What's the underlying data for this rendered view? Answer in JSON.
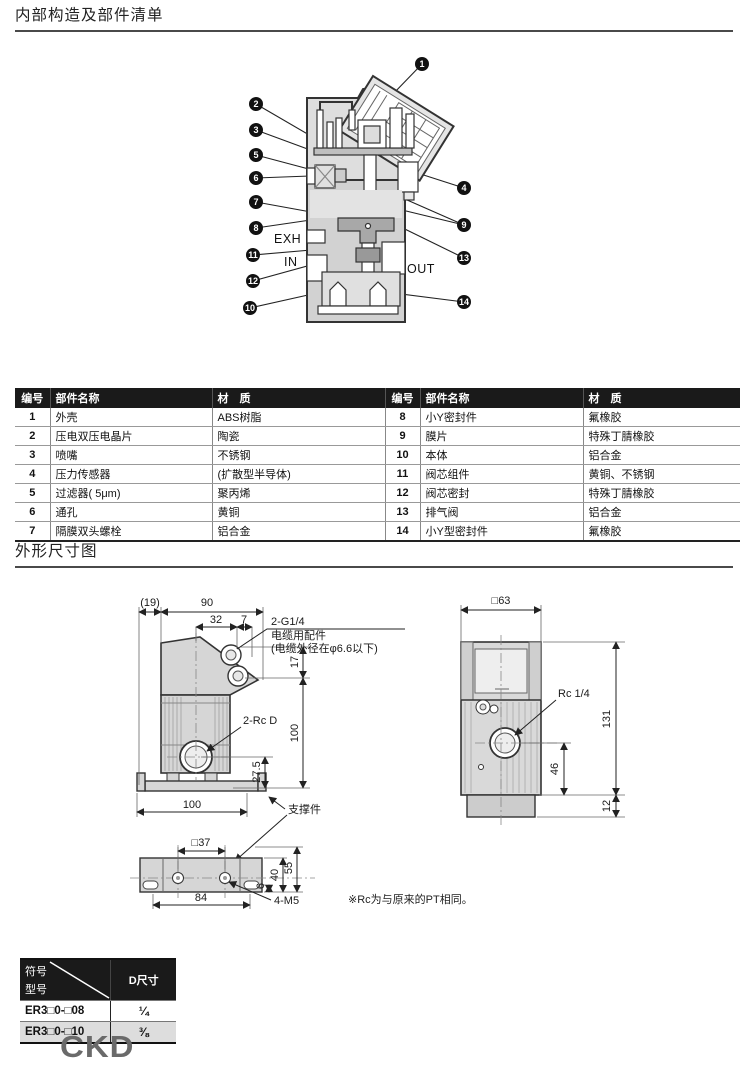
{
  "page": {
    "section1_title": "内部构造及部件清单",
    "section2_title": "外形尺寸图",
    "note": "※Rc为与原来的PT相同。",
    "logo": "CKD"
  },
  "colors": {
    "table_header_bg": "#1a1a1a",
    "alt_row_bg": "#dddddd",
    "drawing_fill": "#d6d6d6",
    "logo_gray": "#6a6a6a"
  },
  "diagram": {
    "callouts": [
      "1",
      "2",
      "3",
      "4",
      "5",
      "6",
      "7",
      "8",
      "9",
      "10",
      "11",
      "12",
      "13",
      "14"
    ],
    "port_labels": {
      "exh": "EXH",
      "in": "IN",
      "out": "OUT"
    }
  },
  "parts_table": {
    "headers": {
      "no": "编号",
      "name": "部件名称",
      "material": "材　质"
    },
    "left_rows": [
      {
        "no": "1",
        "name": "外壳",
        "material": "ABS树脂"
      },
      {
        "no": "2",
        "name": "压电双压电晶片",
        "material": "陶瓷"
      },
      {
        "no": "3",
        "name": "喷嘴",
        "material": "不锈钢"
      },
      {
        "no": "4",
        "name": "压力传感器",
        "material": "(扩散型半导体)"
      },
      {
        "no": "5",
        "name": "过滤器( 5μm)",
        "material": "聚丙烯"
      },
      {
        "no": "6",
        "name": "通孔",
        "material": "黄铜"
      },
      {
        "no": "7",
        "name": "隔膜双头螺栓",
        "material": "铝合金"
      }
    ],
    "right_rows": [
      {
        "no": "8",
        "name": "小Y密封件",
        "material": "氟橡胶"
      },
      {
        "no": "9",
        "name": "膜片",
        "material": "特殊丁腈橡胶"
      },
      {
        "no": "10",
        "name": "本体",
        "material": "铝合金"
      },
      {
        "no": "11",
        "name": "阀芯组件",
        "material": "黄铜、不锈钢"
      },
      {
        "no": "12",
        "name": "阀芯密封",
        "material": "特殊丁腈橡胶"
      },
      {
        "no": "13",
        "name": "排气阀",
        "material": "铝合金"
      },
      {
        "no": "14",
        "name": "小Y型密封件",
        "material": "氟橡胶"
      }
    ]
  },
  "dimensions": {
    "front_view": {
      "d19": "(19)",
      "d90": "90",
      "d32": "32",
      "d7": "7",
      "g14_label": "2-G1/4",
      "cable_label": "电缆用配件",
      "cable_note": "(电缆外径在φ6.6以下)",
      "d17": "17",
      "d100v": "100",
      "rcd_label": "2-Rc D",
      "d27_5": "27.5",
      "d100h": "100",
      "bracket_label": "支撑件"
    },
    "side_view": {
      "d63": "□63",
      "rc14_label": "Rc 1/4",
      "d131": "131",
      "d46": "46",
      "d12": "12"
    },
    "bottom_view": {
      "d37": "□37",
      "d84": "84",
      "m5_label": "4-M5",
      "d6": "6",
      "d40": "40",
      "d55": "55"
    }
  },
  "model_table": {
    "header_symbol": "符号",
    "header_model": "型号",
    "header_d": "D尺寸",
    "rows": [
      {
        "model": "ER3□0-□08",
        "d": "¼"
      },
      {
        "model": "ER3□0-□10",
        "d": "⅜"
      }
    ]
  }
}
